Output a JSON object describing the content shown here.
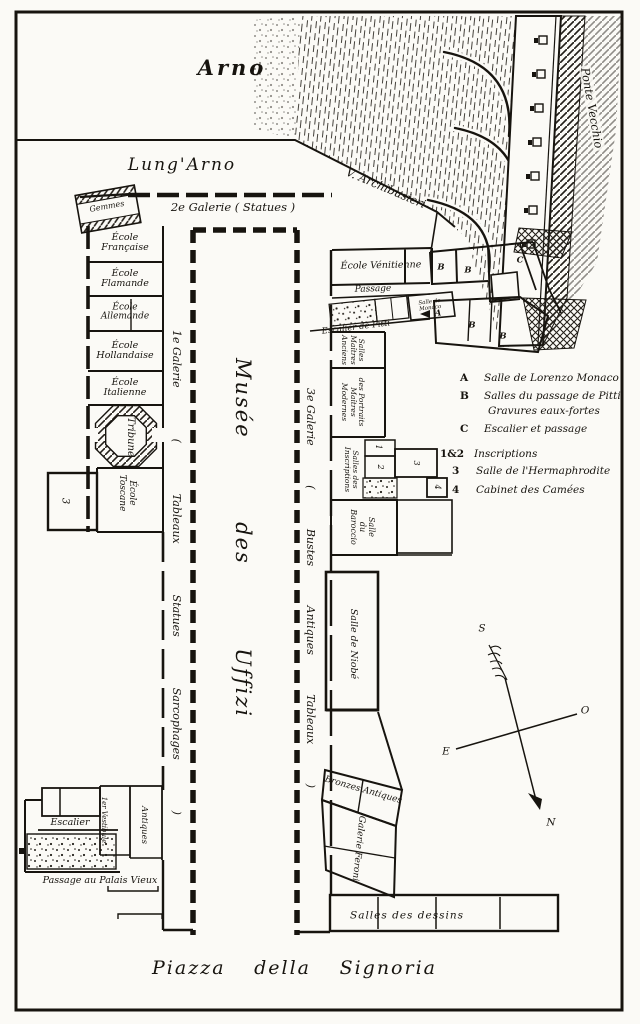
{
  "places": {
    "arno": "Arno",
    "lungarno": "Lung'Arno",
    "archibusieri": "V. Archibusieri",
    "ponte_vecchio": "Ponte Vecchio",
    "piazza_parts": [
      "Piazza",
      "della",
      "Signoria"
    ]
  },
  "galleries": {
    "second": "2e Galerie ( Statues )",
    "first_parts": [
      "1e Galerie",
      "(",
      "Tableaux",
      "Statues",
      "Sarcophages",
      ")"
    ],
    "third_parts": [
      "3e Galerie",
      "(",
      "Bustes",
      "Antiques",
      "Tableaux",
      ")"
    ],
    "musee_parts": [
      "Musée",
      "des",
      "Uffizi"
    ]
  },
  "rooms": {
    "gemmes": "Gemmes",
    "ecole_francaise": [
      "École",
      "Française"
    ],
    "ecole_flamande": [
      "École",
      "Flamande"
    ],
    "ecole_allemande": [
      "École",
      "Allemande"
    ],
    "ecole_hollandaise": [
      "École",
      "Hollandaise"
    ],
    "ecole_italienne": [
      "École",
      "Italienne"
    ],
    "tribune": "Tribune",
    "ecole_toscane": [
      "École",
      "Toscane"
    ],
    "ecole_venitienne": "École Vénitienne",
    "passage": "Passage",
    "escalier_pitti": "Escalier de Pitti",
    "salle_monaco": [
      "Salle de",
      "Monaco"
    ],
    "portraits_anciens": [
      "Salles",
      "Maîtres",
      "Anciens"
    ],
    "portraits_modernes": [
      "des Portraits",
      "Maîtres",
      "Modernes"
    ],
    "inscriptions": [
      "Salles des",
      "Inscriptions"
    ],
    "baroccio": [
      "Salle",
      "du",
      "Baroccio"
    ],
    "niobe": "Salle de Niobé",
    "bronzes": "Bronzes Antiques",
    "feroni": "Galerie Feroni",
    "dessins": "Salles des dessins",
    "vestibule": "1er Vestibule",
    "antiques": "Antiques",
    "escalier": "Escalier",
    "passage_palais": "Passage au Palais Vieux",
    "letter_a": "A",
    "letter_b": "B",
    "letter_c": "C",
    "num_1": "1",
    "num_2": "2",
    "num_3": "3",
    "num_4": "4"
  },
  "legend": {
    "items": [
      {
        "key": "A",
        "text": "Salle de Lorenzo Monaco"
      },
      {
        "key": "B",
        "text": "Salles du passage de Pitti"
      },
      {
        "key": "",
        "text": "Gravures eaux-fortes"
      },
      {
        "key": "C",
        "text": "Escalier et passage"
      },
      {
        "key": "1&2",
        "text": "Inscriptions"
      },
      {
        "key": "3",
        "text": "Salle de l'Hermaphrodite"
      },
      {
        "key": "4",
        "text": "Cabinet des Camées"
      }
    ]
  },
  "compass": {
    "north": "N",
    "south": "S",
    "east": "E",
    "ouest": "O"
  }
}
